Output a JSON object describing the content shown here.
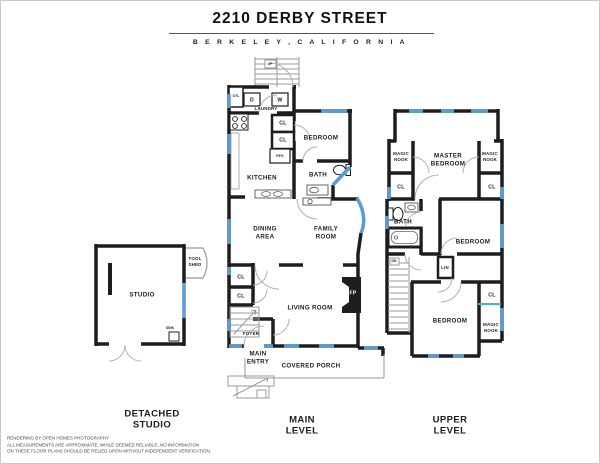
{
  "header": {
    "title": "2210 DERBY STREET",
    "subtitle": "B E R K E L E Y ,   C A L I F O R N I A"
  },
  "plans": {
    "studio": {
      "caption": "DETACHED\nSTUDIO",
      "rooms": {
        "studio": "STUDIO",
        "tool_shed": "TOOL\nSHED",
        "sink": "SINK"
      }
    },
    "main": {
      "caption": "MAIN\nLEVEL",
      "rooms": {
        "utl": "UTL",
        "dryer": "D",
        "washer": "W",
        "laundry": "LAUNDRY",
        "stairs_up": "UP",
        "closet_hall_1": "CL",
        "closet_hall_2": "CL",
        "bedroom": "BEDROOM",
        "refrigerator": "RFG",
        "kitchen": "KITCHEN",
        "bath": "BATH",
        "dining": "DINING\nAREA",
        "family": "FAMILY\nROOM",
        "closet_living_1": "CL",
        "closet_living_2": "CL",
        "living": "LIVING ROOM",
        "fireplace": "FP",
        "foyer": "FOYER",
        "entry": "MAIN\nENTRY",
        "porch": "COVERED PORCH"
      }
    },
    "upper": {
      "caption": "UPPER\nLEVEL",
      "rooms": {
        "magic_nook_left": "MAGIC\nNOOK",
        "master": "MASTER\nBEDROOM",
        "magic_nook_right": "MAGIC\nNOOK",
        "closet_left": "CL",
        "closet_right": "CL",
        "bath": "BATH",
        "bedroom_mid": "BEDROOM",
        "linen": "LIN",
        "stairs_down": "DN",
        "bedroom_low": "BEDROOM",
        "closet_low": "CL",
        "magic_nook_low": "MAGIC\nNOOK"
      }
    }
  },
  "footer": {
    "lines": [
      "RENDERING BY OPEN HOMES PHOTOGRAPHY",
      "ALL MEASUREMENTS ARE APPROXIMATE. WHILE DEEMED RELIABLE, NO INFORMATION",
      "ON THESE FLOOR PLANS SHOULD BE RELIED UPON WITHOUT INDEPENDENT VERIFICATION."
    ]
  },
  "colors": {
    "wall": "#1d1d1d",
    "window": "#5b9bd5",
    "skylight": "#45b8a8",
    "door": "#b0b0b0",
    "stair": "#9a9a9a"
  }
}
